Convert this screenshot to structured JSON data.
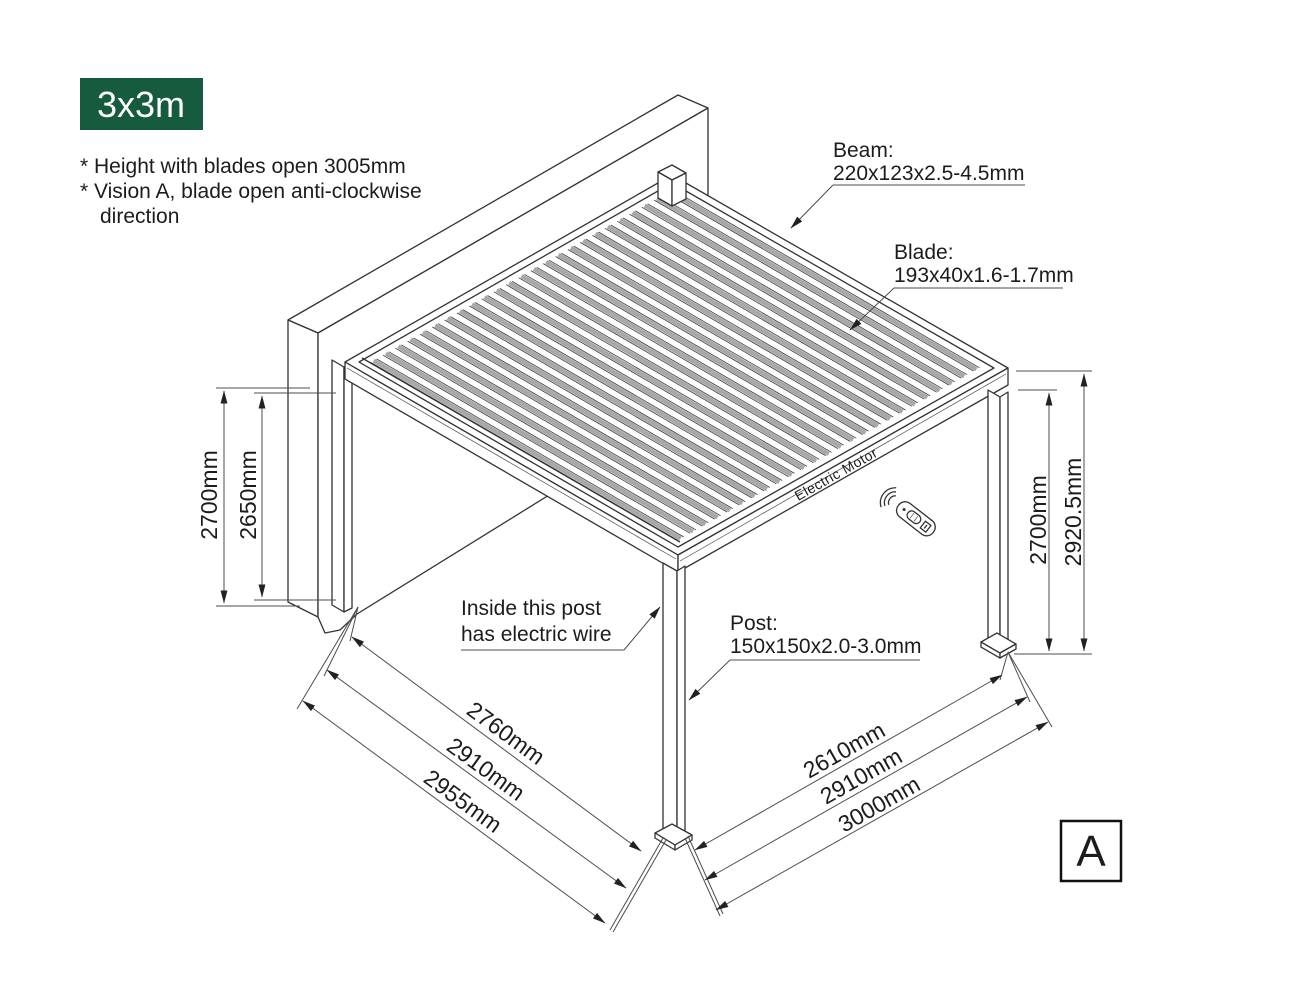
{
  "badge": {
    "label": "3x3m"
  },
  "notes": {
    "line1": "* Height with blades open 3005mm",
    "line2": "* Vision A, blade open anti-clockwise",
    "line3": "direction"
  },
  "callouts": {
    "beam": {
      "title": "Beam:",
      "spec": "220x123x2.5-4.5mm"
    },
    "blade": {
      "title": "Blade:",
      "spec": "193x40x1.6-1.7mm"
    },
    "post": {
      "title": "Post:",
      "spec": "150x150x2.0-3.0mm"
    },
    "electric_wire": {
      "line1": "Inside this post",
      "line2": "has electric wire"
    }
  },
  "motor_label": "Electric Motor",
  "dimensions": {
    "left": {
      "outer": "2700mm",
      "inner": "2650mm"
    },
    "right": {
      "inner": "2700mm",
      "outer": "2920.5mm"
    },
    "bottom_left": [
      "2760mm",
      "2910mm",
      "2955mm"
    ],
    "bottom_right": [
      "2610mm",
      "2910mm",
      "3000mm"
    ]
  },
  "view_label": "A",
  "colors": {
    "badge_green": "#165B3E",
    "line": "#333333",
    "blade_gray": "#A8A8A8"
  }
}
